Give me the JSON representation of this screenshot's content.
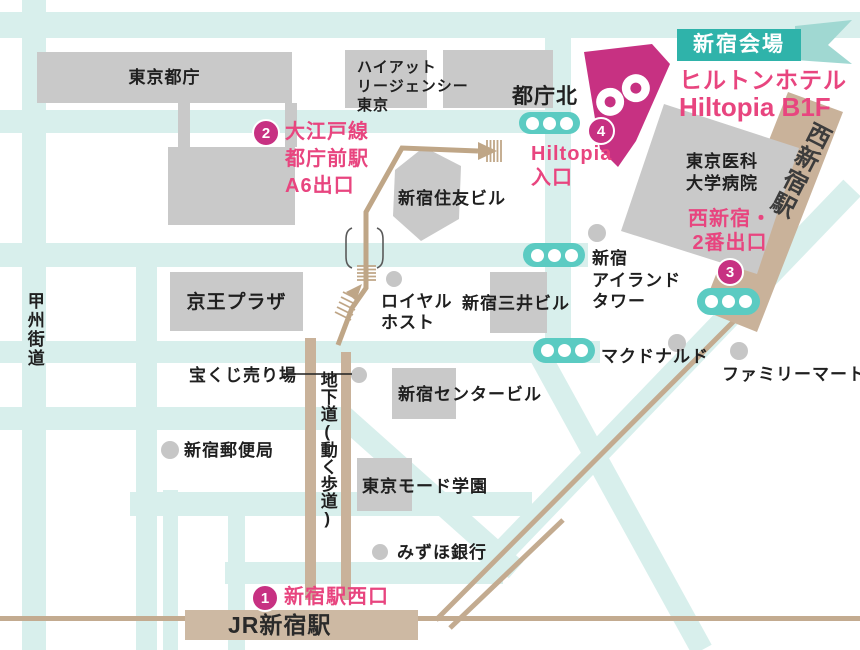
{
  "banner": {
    "venue": "新宿会場"
  },
  "venue": {
    "hotel": "ヒルトンホテル",
    "floor": "Hiltopia B1F"
  },
  "markers": {
    "m1": {
      "num": "1",
      "label": "新宿駅西口"
    },
    "m2": {
      "num": "2",
      "lines": [
        "大江戸線",
        "都庁前駅",
        "A6出口"
      ]
    },
    "m3": {
      "num": "3",
      "lines": [
        "西新宿・",
        "2番出口"
      ]
    },
    "m4": {
      "num": "4",
      "lines": [
        "Hiltopia",
        "入口"
      ]
    }
  },
  "bus_stops": {
    "tochokita": "都庁北"
  },
  "places": {
    "tocho": "東京都庁",
    "hyatt_lines": [
      "ハイアット",
      "リージェンシー",
      "東京"
    ],
    "sumitomo": "新宿住友ビル",
    "keio_plaza": "京王プラザ",
    "royal_host_lines": [
      "ロイヤル",
      "ホスト"
    ],
    "mitsui": "新宿三井ビル",
    "island_lines": [
      "新宿",
      "アイランド",
      "タワー"
    ],
    "mcdonalds": "マクドナルド",
    "familymart": "ファミリーマート",
    "takarakuji": "宝くじ売り場",
    "post_office": "新宿郵便局",
    "center_bldg": "新宿センタービル",
    "mode_gakuen": "東京モード学園",
    "mizuho": "みずほ銀行",
    "hospital_lines": [
      "東京医科",
      "大学病院"
    ]
  },
  "roads": {
    "koshu_kaido": "甲州街道",
    "underground": "地下道(動く歩道)",
    "nishi_shinjuku_station": "西新宿駅",
    "jr_shinjuku_station": "JR新宿駅"
  },
  "colors": {
    "accent_magenta": "#c73182",
    "pink_text": "#e8457f",
    "banner_teal": "#2fb3aa",
    "banner_tail_teal": "#a0d8d2",
    "bus_stop_teal": "#5bcbc2",
    "road_teal": "#d8efec",
    "road_tan": "#c9b29a",
    "building_gray": "#c9c9c9"
  }
}
